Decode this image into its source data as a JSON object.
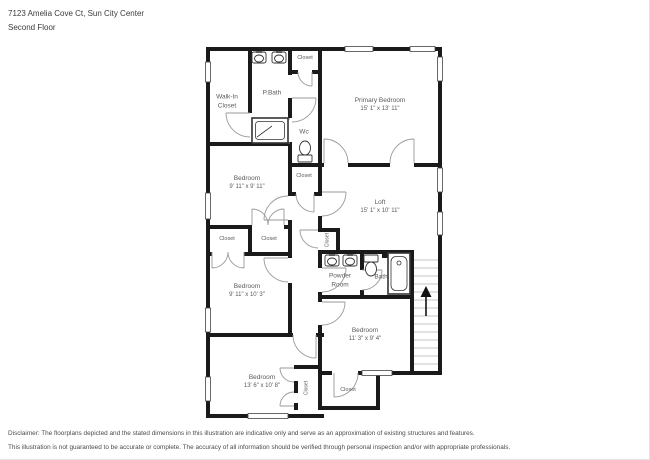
{
  "header": {
    "address": "7123 Amelia Cove Ct, Sun City Center",
    "floor": "Second Floor"
  },
  "rooms": [
    {
      "name": "Walk-In Closet",
      "dims": ""
    },
    {
      "name": "P.Bath",
      "dims": ""
    },
    {
      "name": "Closet",
      "dims": ""
    },
    {
      "name": "Primary Bedroom",
      "dims": "15' 1\" x 13' 11\""
    },
    {
      "name": "Wc",
      "dims": ""
    },
    {
      "name": "Closet",
      "dims": ""
    },
    {
      "name": "Bedroom",
      "dims": "9' 11\" x 9' 11\""
    },
    {
      "name": "Loft",
      "dims": "15' 1\" x 10' 11\""
    },
    {
      "name": "Closet",
      "dims": ""
    },
    {
      "name": "Closet",
      "dims": ""
    },
    {
      "name": "Closet",
      "dims": ""
    },
    {
      "name": "Powder Room",
      "dims": ""
    },
    {
      "name": "Bath",
      "dims": ""
    },
    {
      "name": "Bedroom",
      "dims": "9' 11\" x 10' 3\""
    },
    {
      "name": "Bedroom",
      "dims": "11' 3\" x 9' 4\""
    },
    {
      "name": "Bedroom",
      "dims": "13' 6\" x 10' 8\""
    },
    {
      "name": "Closet",
      "dims": ""
    },
    {
      "name": "Closet",
      "dims": ""
    }
  ],
  "stairs": {
    "direction": "up"
  },
  "disclaimer": {
    "line1": "Disclaimer: The floorplans depicted and the stated dimensions in this illustration are indicative only and serve as an approximation of existing structures and features.",
    "line2": "This illustration is not guaranteed to be accurate or complete. The accuracy of all information should be verified through personal inspection and/or with appropriate professionals."
  }
}
